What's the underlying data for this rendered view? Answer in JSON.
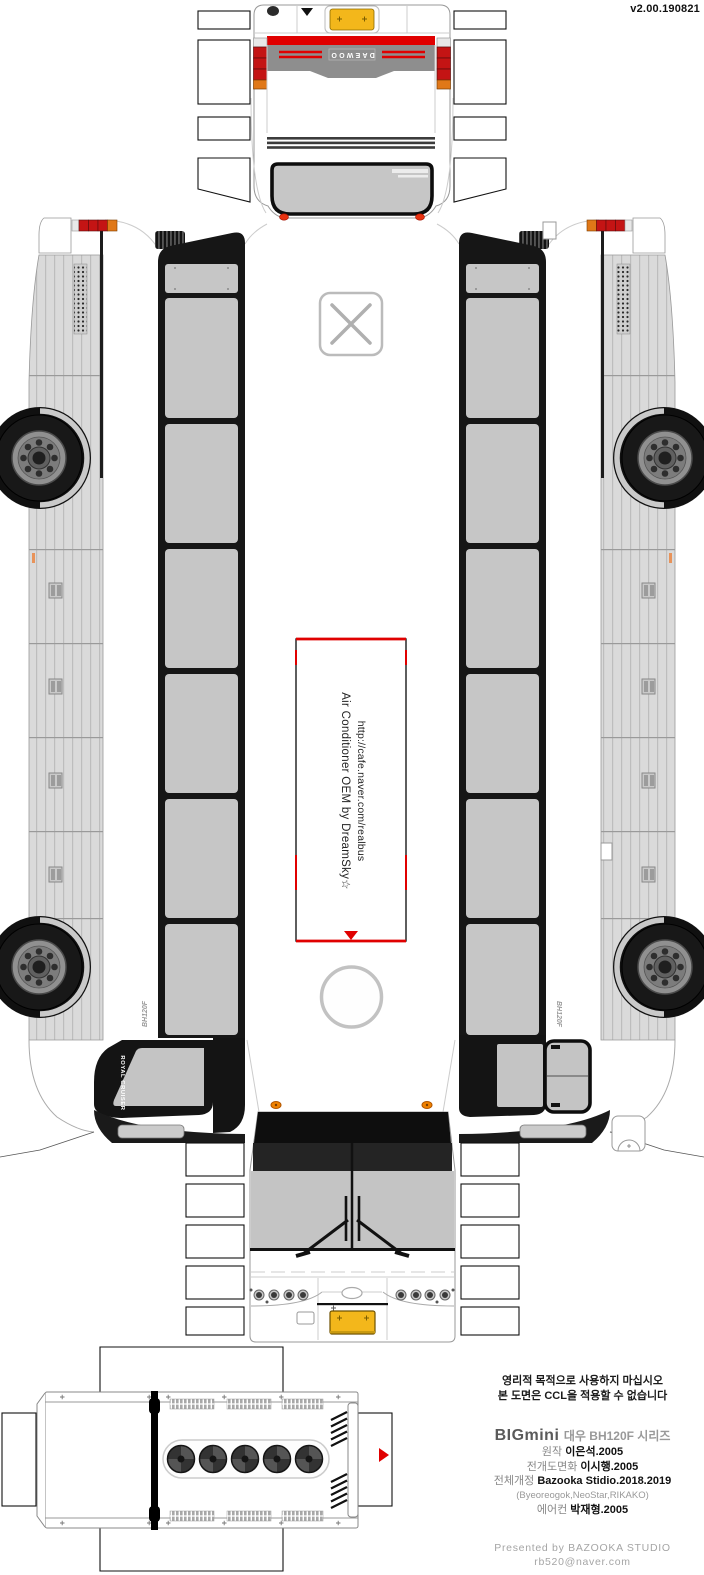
{
  "meta": {
    "version": "v2.00.190821"
  },
  "colors": {
    "accent_red": "#e00000",
    "signal_orange": "#e07818",
    "plate_yellow": "#f3b71b",
    "window_gray": "#c6c6c6",
    "band_black": "#161616",
    "skirt_gray": "#dadada",
    "rear_panel_gray": "#8e8e8e"
  },
  "rear_view": {
    "brand_badge": "DAEWOO"
  },
  "roof": {
    "ac_note_line1": "Air Conditioner OEM by DreamSky☆",
    "ac_note_line2": "http://cafe.naver.com/realbus"
  },
  "sides": {
    "front_pillar_label": "ROYAL CRUISER",
    "model_label": "BH120F"
  },
  "credits": {
    "notice_line1": "영리적 목적으로 사용하지 마십시오",
    "notice_line2": "본 도면은 CCL을 적용할 수 없습니다",
    "series_logo": "BIGmini",
    "series_title": "대우 BH120F 시리즈",
    "rows": [
      {
        "label": "원작",
        "value": "이은석.2005"
      },
      {
        "label": "전개도면화",
        "value": "이시행.2005"
      },
      {
        "label": "전체개정",
        "value": "Bazooka Stidio.2018.2019"
      },
      {
        "label": "",
        "value": "(Byeoreogok,NeoStar,RIKAKO)"
      },
      {
        "label": "에어컨",
        "value": "박재형.2005"
      }
    ],
    "footer_line1": "Presented by BAZOOKA STUDIO",
    "footer_line2": "rb520@naver.com"
  }
}
